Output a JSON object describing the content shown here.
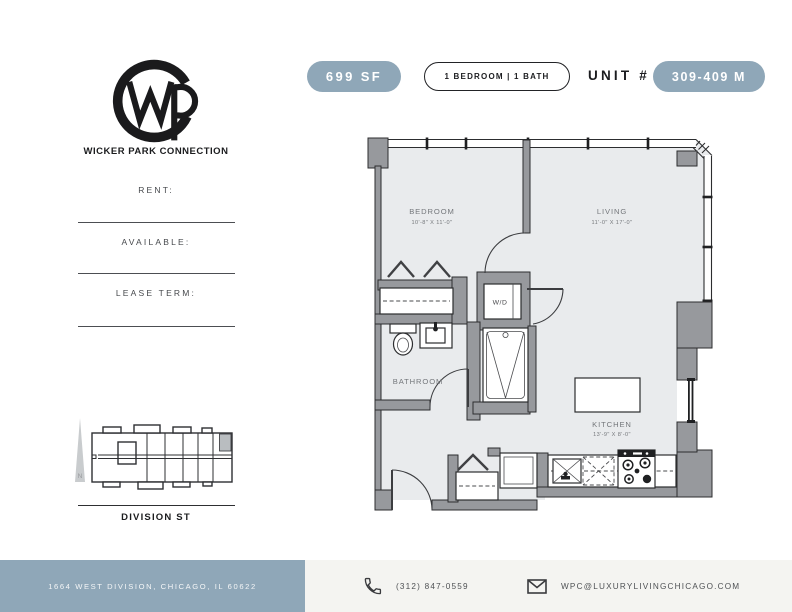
{
  "brand": {
    "name": "WICKER PARK CONNECTION"
  },
  "header": {
    "sf_badge": "699 SF",
    "bed_bath_badge": "1 BEDROOM | 1 BATH",
    "unit_label": "UNIT #",
    "unit_badge": "309-409 M"
  },
  "sidebar": {
    "fields": [
      {
        "label": "RENT:"
      },
      {
        "label": "AVAILABLE:"
      },
      {
        "label": "LEASE TERM:"
      }
    ],
    "map": {
      "street": "DIVISION ST",
      "north": "N"
    }
  },
  "floorplan": {
    "bedroom": {
      "name": "BEDROOM",
      "dims": "10'-8\" X 11'-0\""
    },
    "living": {
      "name": "LIVING",
      "dims": "11'-0\" X 17'-0\""
    },
    "bathroom": {
      "name": "BATHROOM"
    },
    "kitchen": {
      "name": "KITCHEN",
      "dims": "13'-9\" X 8'-0\""
    },
    "washer_dryer": "W/D"
  },
  "footer": {
    "address": "1664 WEST DIVISION, CHICAGO, IL 60622",
    "phone": "(312) 847-0559",
    "email": "WPC@LUXURYLIVINGCHICAGO.COM"
  },
  "colors": {
    "accent": "#8FA7B8",
    "footer_bg": "#F4F4F1",
    "wall": "#97999D",
    "floor": "#E9EBED"
  }
}
